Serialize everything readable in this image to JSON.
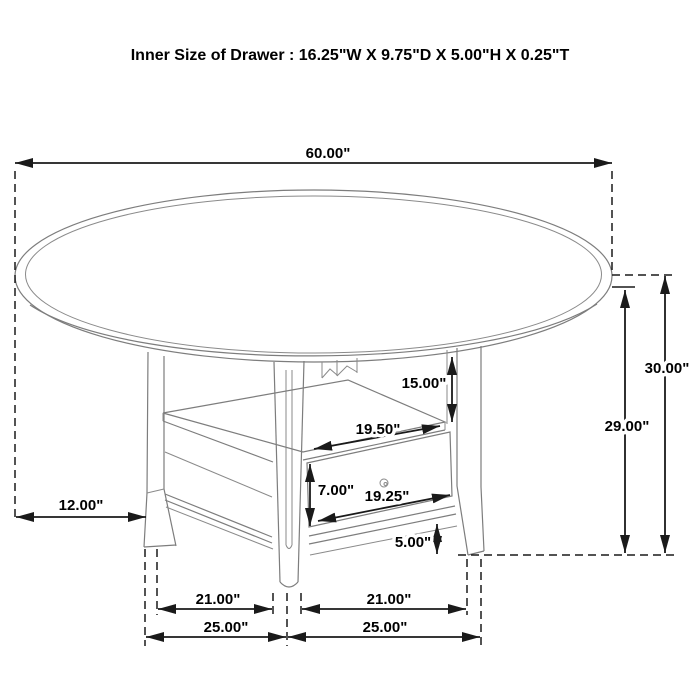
{
  "title": "Inner Size of Drawer : 16.25\"W X 9.75\"D X 5.00\"H X 0.25\"T",
  "dimensions": {
    "table_top_diameter": "60.00\"",
    "overall_height": "30.00\"",
    "floor_to_tabletop_underside": "29.00\"",
    "tabletop_to_shelf": "15.00\"",
    "shelf_opening_width": "19.50\"",
    "drawer_front_height": "7.00\"",
    "drawer_front_width": "19.25\"",
    "bottom_rail_height": "5.00\"",
    "tabletop_overhang": "12.00\"",
    "leg_inner_span_left": "21.00\"",
    "leg_inner_span_right": "21.00\"",
    "base_width_left": "25.00\"",
    "base_width_right": "25.00\""
  },
  "colors": {
    "background": "#ffffff",
    "furniture_line": "#7d7d7d",
    "dimension_line": "#1a1a1a",
    "text": "#000000"
  }
}
